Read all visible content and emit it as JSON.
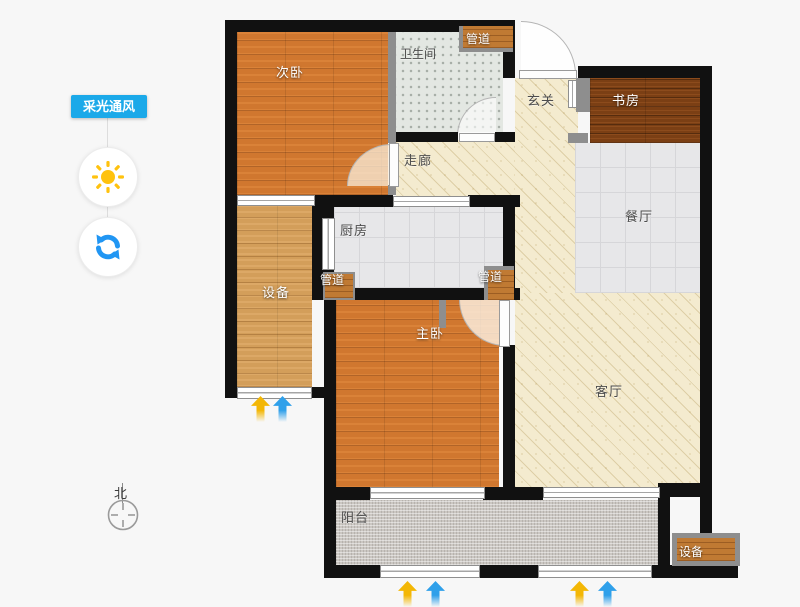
{
  "sidebar": {
    "toggle_label": "采光通风",
    "accent_color": "#1ba9e9",
    "sun_color": "#ffc20e",
    "refresh_color": "#2196f3"
  },
  "compass": {
    "north": "北"
  },
  "rooms": {
    "secondary_bedroom": "次卧",
    "bathroom": "卫生间",
    "pipe_top": "管道",
    "entry_hall": "玄关",
    "study": "书房",
    "corridor": "走廊",
    "dining": "餐厅",
    "kitchen": "厨房",
    "pipe_kitchen_left": "管道",
    "pipe_kitchen_right": "管道",
    "equipment_left": "设备",
    "master_bedroom": "主卧",
    "living": "客厅",
    "balcony": "阳台",
    "equipment_bottom_right": "设备"
  },
  "colors": {
    "wall": "#111111",
    "inner_wall": "#8e8e8e",
    "bedroom_floor": "#d0772f",
    "equipment_floor": "#d39e5a",
    "study_floor": "#7b3f14",
    "tile_floor": "#e7e7e9",
    "bathroom_floor": "#e3e7e2",
    "hall_floor": "#f4ebcf",
    "balcony_floor": "#cbc7c2",
    "light_arrow": "#f3b705",
    "wind_arrow": "#2fa0ea"
  }
}
